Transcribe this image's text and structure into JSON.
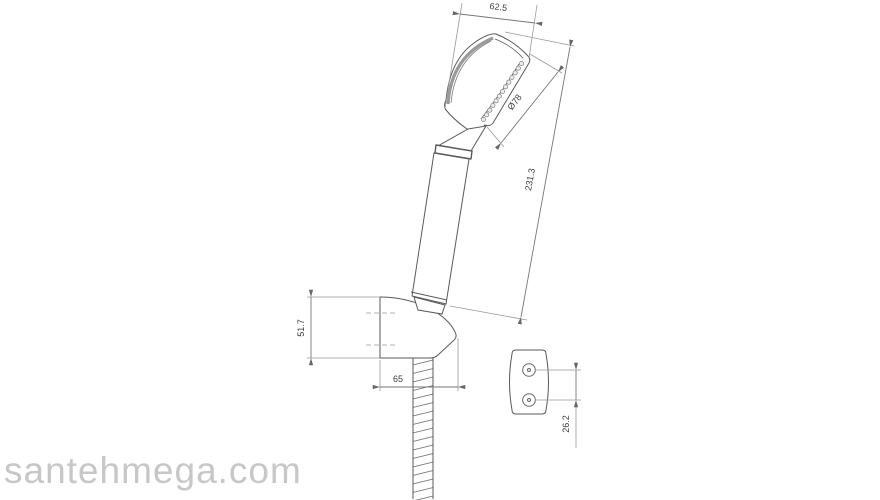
{
  "watermark": {
    "text": "santehmega.com"
  },
  "drawing": {
    "type": "technical-drawing",
    "subject": "hand shower with wall holder, hose and wall plate",
    "dimensions": {
      "head_width_top": "62.5",
      "head_face_diameter": "Ø78",
      "overall_length": "231.3",
      "holder_height": "51.7",
      "holder_depth": "65",
      "wall_plate_hole_spacing": "26.2"
    },
    "colors": {
      "outline": "#5a5a5a",
      "dimension_line": "#8c8c8c",
      "dimension_text": "#3a3a3a",
      "shading": "#9a9a9a",
      "watermark": "#c7c7c7",
      "background": "#ffffff"
    }
  }
}
